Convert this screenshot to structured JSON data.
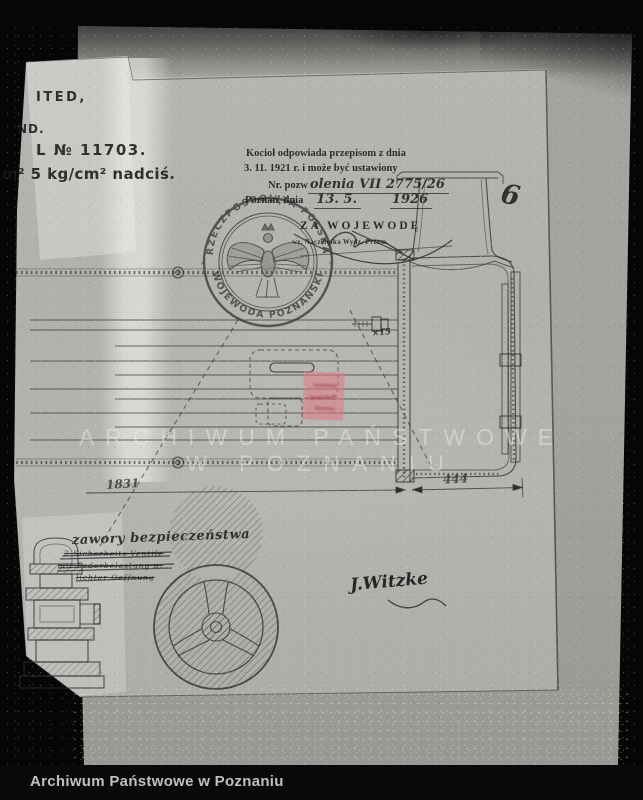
{
  "footer": {
    "label": "Archiwum Państwowe w Poznaniu"
  },
  "watermark": {
    "line1": "ARCHIWUM PAŃSTWOWE",
    "line2": "W POZNANIU"
  },
  "corner_note": {
    "line1": "ITED,",
    "line2": "ND.",
    "line3": "L № 11703.",
    "line4": "m² 5 kg/cm² nadciś."
  },
  "approval_stamp": {
    "line1": "Kocioł odpowiada przepisom z dnia",
    "line2": "3. 11. 1921 r. i może być ustawiony",
    "permit_label": "Nr. pozw",
    "permit_value": "olenia VII 2775/26",
    "place_label": "Poznań, dnia",
    "date_day": "13. 5.",
    "date_year": "1926",
    "za_wojewode": "ZA WOJEWODĘ",
    "deputy_note": "wz. Naczelnika Wydz. Przem."
  },
  "seal": {
    "text_top": "RZECZPOSPOLITA POLSKA",
    "text_bottom": "WOJEWODA POZNAŃSKI",
    "star": "✶"
  },
  "drawing": {
    "page_number": "6",
    "dim_total": "1831",
    "dim_right": "444",
    "bolt_note": "×15",
    "valve_caption": "zawory bezpieczeństwa",
    "struck_lines": [
      "2 Sicherheits-Ventile",
      "mit Federbelastung u.",
      "lichter Oeffnung"
    ],
    "signature": "J.Witzke"
  },
  "colors": {
    "backing_paper": "#a3a39f",
    "drawing_sheet": "#b2b2ae",
    "ink": "#2f2f2f",
    "seal_ink": "#3a3a3a",
    "stamp_red": "#e07a86",
    "footer_bg": "#090909",
    "footer_text": "#c0c0c0",
    "watermark": "#eaeae5"
  }
}
